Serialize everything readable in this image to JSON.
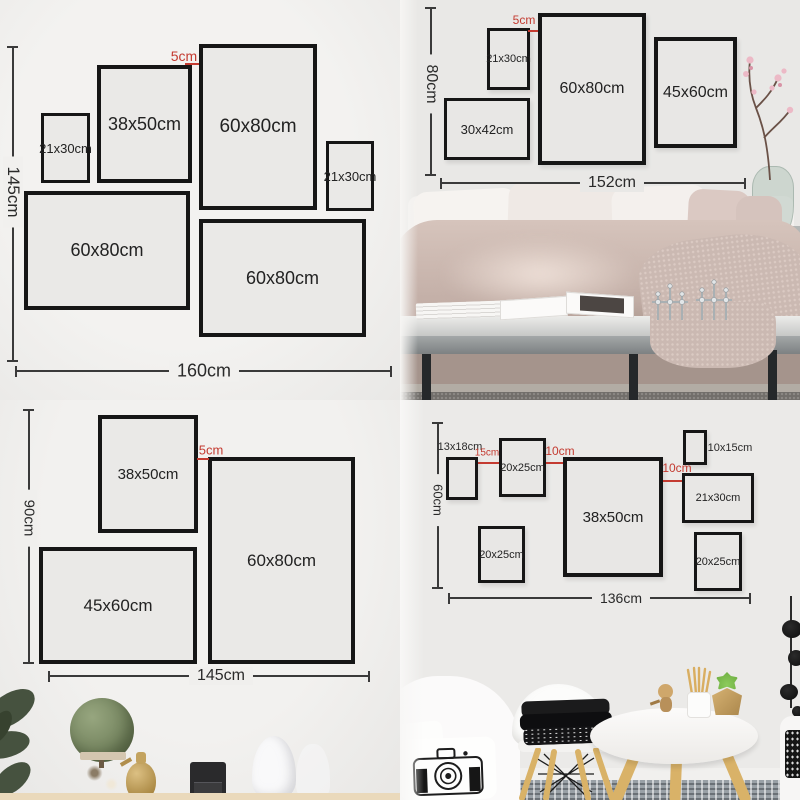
{
  "colors": {
    "accent_red": "#c43b31",
    "frame_border": "#161616",
    "dimension_line": "#3a3a3a"
  },
  "quadrants": {
    "top_left": {
      "height_label": "145cm",
      "width_label": "160cm",
      "gap_label": "5cm",
      "frames": [
        {
          "label": "21x30cm"
        },
        {
          "label": "38x50cm"
        },
        {
          "label": "60x80cm"
        },
        {
          "label": "21x30cm"
        },
        {
          "label": "60x80cm"
        },
        {
          "label": "60x80cm"
        }
      ]
    },
    "top_right": {
      "height_label": "80cm",
      "width_label": "152cm",
      "gap_label": "5cm",
      "frames": [
        {
          "label": "21x30cm"
        },
        {
          "label": "60x80cm"
        },
        {
          "label": "45x60cm"
        },
        {
          "label": "30x42cm"
        }
      ]
    },
    "bottom_left": {
      "height_label": "90cm",
      "width_label": "145cm",
      "gap_label": "5cm",
      "frames": [
        {
          "label": "38x50cm"
        },
        {
          "label": "60x80cm"
        },
        {
          "label": "45x60cm"
        }
      ]
    },
    "bottom_right": {
      "height_label": "60cm",
      "width_label": "136cm",
      "gap_labels": [
        "15cm",
        "10cm",
        "10cm"
      ],
      "frames": [
        {
          "label": "13x18cm"
        },
        {
          "label": "20x25cm"
        },
        {
          "label": "38x50cm"
        },
        {
          "label": "10x15cm"
        },
        {
          "label": "21x30cm"
        },
        {
          "label": "20x25cm"
        },
        {
          "label": "20x25cm"
        }
      ]
    }
  }
}
